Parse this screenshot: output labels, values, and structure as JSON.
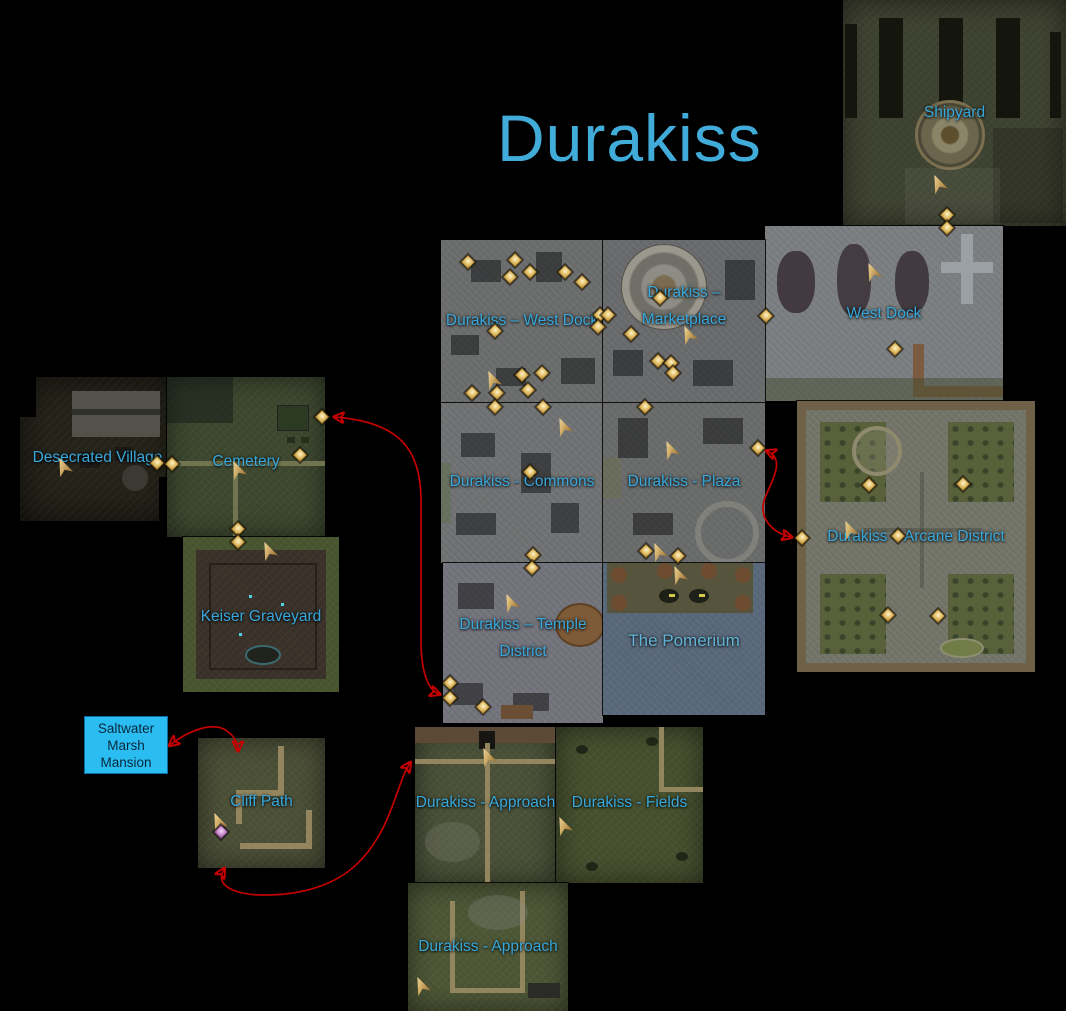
{
  "title": "Durakiss",
  "colors": {
    "label_blue": "#38a8dc",
    "title_blue": "#41acd9",
    "arrow_red": "#c40000",
    "mansion_box_fill": "#2bbdf2",
    "marker_gold": "#d9b873",
    "marker_purple": "#cf8fd2",
    "pomerium_slate": "#5a6a7c"
  },
  "tiles": {
    "shipyard": {
      "label": "Shipyard"
    },
    "west_dock": {
      "label": "West Dock"
    },
    "durakiss_west_dock": {
      "label": "Durakiss – West Dock"
    },
    "marketplace": {
      "label": "Durakiss –",
      "label2": "Marketplace"
    },
    "commons": {
      "label": "Durakiss - Commons"
    },
    "plaza": {
      "label": "Durakiss - Plaza"
    },
    "arcane_district": {
      "label": "Durakiss – Arcane District"
    },
    "temple_district": {
      "label": "Durakiss – Temple",
      "label2": "District"
    },
    "pomerium": {
      "label": "The Pomerium"
    },
    "desecrated_village": {
      "label": "Desecrated Village"
    },
    "cemetery": {
      "label": "Cemetery"
    },
    "keiser_graveyard": {
      "label": "Keiser Graveyard"
    },
    "cliff_path": {
      "label": "Cliff Path"
    },
    "approach_north": {
      "label": "Durakiss - Approach"
    },
    "fields": {
      "label": "Durakiss - Fields"
    },
    "approach_south": {
      "label": "Durakiss - Approach"
    }
  },
  "mansion_box": {
    "line1": "Saltwater",
    "line2": "Marsh",
    "line3": "Mansion"
  },
  "markers": [
    {
      "x": 938,
      "y": 184,
      "type": "cursor"
    },
    {
      "x": 947,
      "y": 215,
      "type": "diamond"
    },
    {
      "x": 947,
      "y": 228,
      "type": "diamond"
    },
    {
      "x": 872,
      "y": 272,
      "type": "cursor"
    },
    {
      "x": 766,
      "y": 316,
      "type": "diamond"
    },
    {
      "x": 895,
      "y": 349,
      "type": "diamond"
    },
    {
      "x": 468,
      "y": 262,
      "type": "diamond"
    },
    {
      "x": 515,
      "y": 260,
      "type": "diamond"
    },
    {
      "x": 530,
      "y": 272,
      "type": "diamond"
    },
    {
      "x": 510,
      "y": 277,
      "type": "diamond"
    },
    {
      "x": 565,
      "y": 272,
      "type": "diamond"
    },
    {
      "x": 582,
      "y": 282,
      "type": "diamond"
    },
    {
      "x": 495,
      "y": 331,
      "type": "diamond"
    },
    {
      "x": 492,
      "y": 380,
      "type": "cursor"
    },
    {
      "x": 522,
      "y": 375,
      "type": "diamond"
    },
    {
      "x": 542,
      "y": 373,
      "type": "diamond"
    },
    {
      "x": 528,
      "y": 390,
      "type": "diamond"
    },
    {
      "x": 472,
      "y": 393,
      "type": "diamond"
    },
    {
      "x": 497,
      "y": 393,
      "type": "diamond"
    },
    {
      "x": 600,
      "y": 315,
      "type": "diamond"
    },
    {
      "x": 608,
      "y": 315,
      "type": "diamond"
    },
    {
      "x": 598,
      "y": 327,
      "type": "diamond"
    },
    {
      "x": 660,
      "y": 298,
      "type": "diamond"
    },
    {
      "x": 631,
      "y": 334,
      "type": "diamond"
    },
    {
      "x": 688,
      "y": 335,
      "type": "cursor"
    },
    {
      "x": 658,
      "y": 361,
      "type": "diamond"
    },
    {
      "x": 671,
      "y": 363,
      "type": "diamond"
    },
    {
      "x": 673,
      "y": 373,
      "type": "diamond"
    },
    {
      "x": 495,
      "y": 407,
      "type": "diamond"
    },
    {
      "x": 543,
      "y": 407,
      "type": "diamond"
    },
    {
      "x": 563,
      "y": 427,
      "type": "cursor"
    },
    {
      "x": 530,
      "y": 472,
      "type": "diamond"
    },
    {
      "x": 533,
      "y": 555,
      "type": "diamond"
    },
    {
      "x": 645,
      "y": 407,
      "type": "diamond"
    },
    {
      "x": 670,
      "y": 450,
      "type": "cursor"
    },
    {
      "x": 758,
      "y": 448,
      "type": "diamond"
    },
    {
      "x": 646,
      "y": 551,
      "type": "diamond"
    },
    {
      "x": 678,
      "y": 556,
      "type": "diamond"
    },
    {
      "x": 658,
      "y": 552,
      "type": "cursor"
    },
    {
      "x": 532,
      "y": 568,
      "type": "diamond"
    },
    {
      "x": 510,
      "y": 603,
      "type": "cursor"
    },
    {
      "x": 450,
      "y": 683,
      "type": "diamond"
    },
    {
      "x": 450,
      "y": 698,
      "type": "diamond"
    },
    {
      "x": 483,
      "y": 707,
      "type": "diamond"
    },
    {
      "x": 678,
      "y": 575,
      "type": "cursor"
    },
    {
      "x": 849,
      "y": 530,
      "type": "cursor"
    },
    {
      "x": 869,
      "y": 485,
      "type": "diamond"
    },
    {
      "x": 963,
      "y": 484,
      "type": "diamond"
    },
    {
      "x": 802,
      "y": 538,
      "type": "diamond"
    },
    {
      "x": 898,
      "y": 536,
      "type": "diamond"
    },
    {
      "x": 888,
      "y": 615,
      "type": "diamond"
    },
    {
      "x": 938,
      "y": 616,
      "type": "diamond"
    },
    {
      "x": 322,
      "y": 417,
      "type": "diamond"
    },
    {
      "x": 300,
      "y": 455,
      "type": "diamond"
    },
    {
      "x": 237,
      "y": 470,
      "type": "cursor"
    },
    {
      "x": 172,
      "y": 464,
      "type": "diamond"
    },
    {
      "x": 238,
      "y": 529,
      "type": "diamond"
    },
    {
      "x": 157,
      "y": 463,
      "type": "diamond"
    },
    {
      "x": 63,
      "y": 467,
      "type": "cursor"
    },
    {
      "x": 238,
      "y": 542,
      "type": "diamond"
    },
    {
      "x": 268,
      "y": 551,
      "type": "cursor"
    },
    {
      "x": 218,
      "y": 822,
      "type": "cursor"
    },
    {
      "x": 221,
      "y": 832,
      "type": "purple"
    },
    {
      "x": 487,
      "y": 757,
      "type": "cursor"
    },
    {
      "x": 563,
      "y": 826,
      "type": "cursor"
    },
    {
      "x": 421,
      "y": 986,
      "type": "cursor"
    }
  ]
}
